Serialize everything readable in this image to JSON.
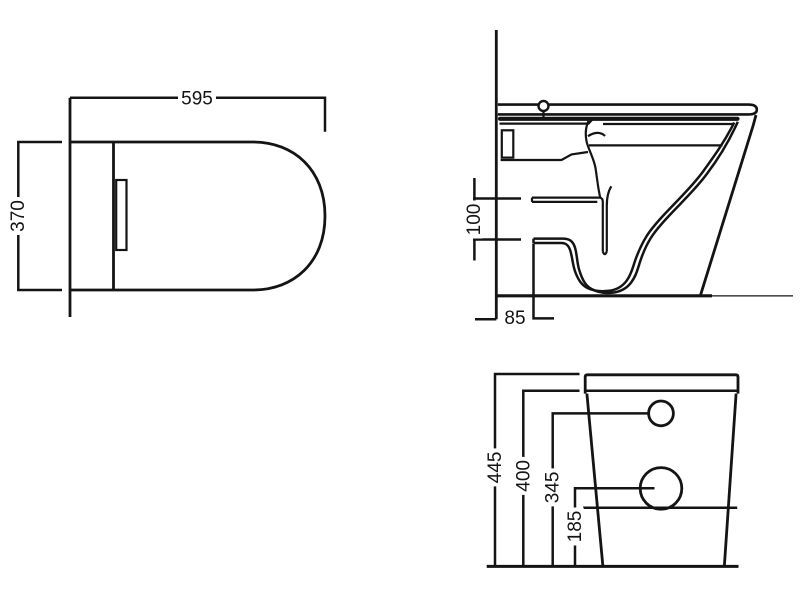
{
  "colors": {
    "line": "#141414",
    "background": "#ffffff"
  },
  "views": {
    "plan": {
      "dim_width": "595",
      "dim_depth": "370"
    },
    "side": {
      "dim_trap_inlet_height": "100",
      "dim_outlet_setout": "85"
    },
    "rear": {
      "dim_overall_height": "445",
      "dim_tank_shoulder_height": "400",
      "dim_inlet_hole_height": "345",
      "dim_outlet_hole_height": "185"
    }
  }
}
